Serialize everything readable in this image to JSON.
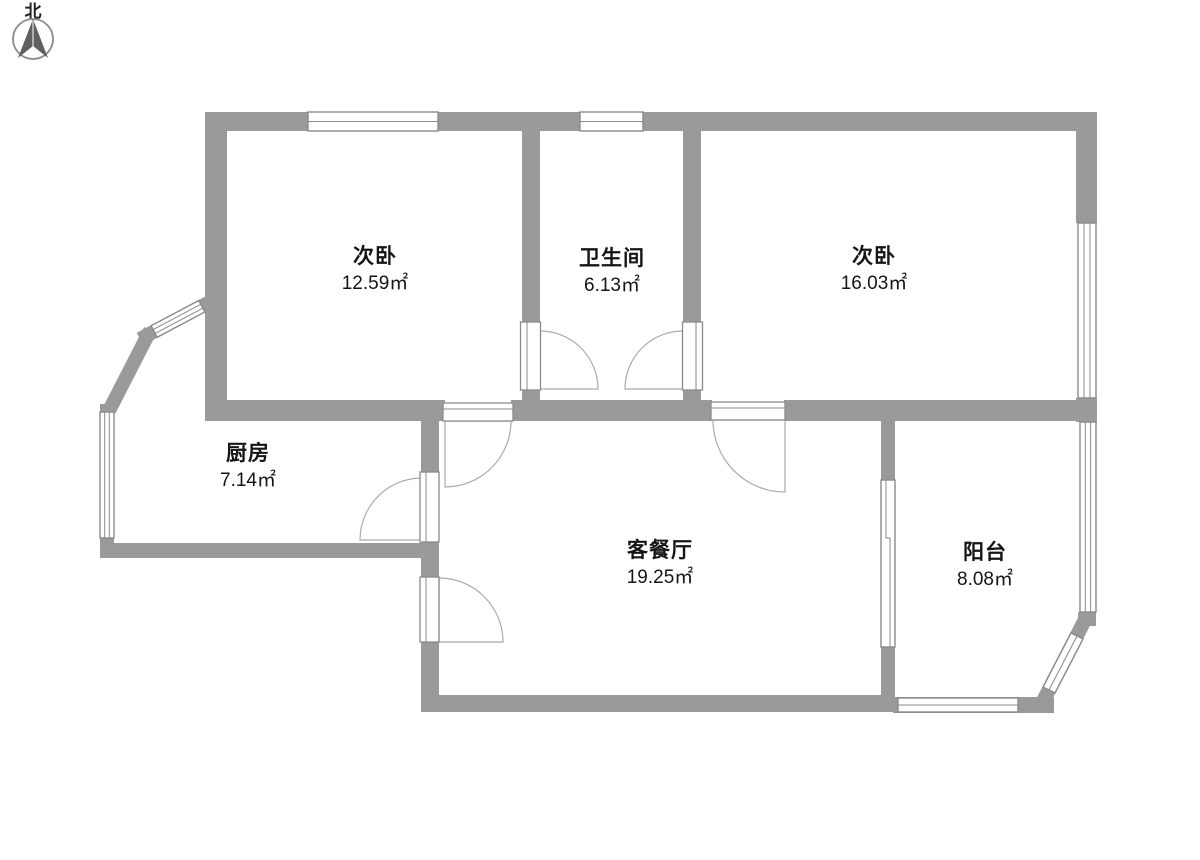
{
  "compass": {
    "label": "北"
  },
  "rooms": [
    {
      "id": "bedroom-left",
      "name": "次卧",
      "area": "12.59㎡"
    },
    {
      "id": "bathroom",
      "name": "卫生间",
      "area": "6.13㎡"
    },
    {
      "id": "bedroom-right",
      "name": "次卧",
      "area": "16.03㎡"
    },
    {
      "id": "kitchen",
      "name": "厨房",
      "area": "7.14㎡"
    },
    {
      "id": "living-dining",
      "name": "客餐厅",
      "area": "19.25㎡"
    },
    {
      "id": "balcony",
      "name": "阳台",
      "area": "8.08㎡"
    }
  ],
  "colors": {
    "wall": "#9a9a9a",
    "frame": "#8a8a8a",
    "arc": "#ababab",
    "needle": "#606060",
    "text": "#151515"
  }
}
